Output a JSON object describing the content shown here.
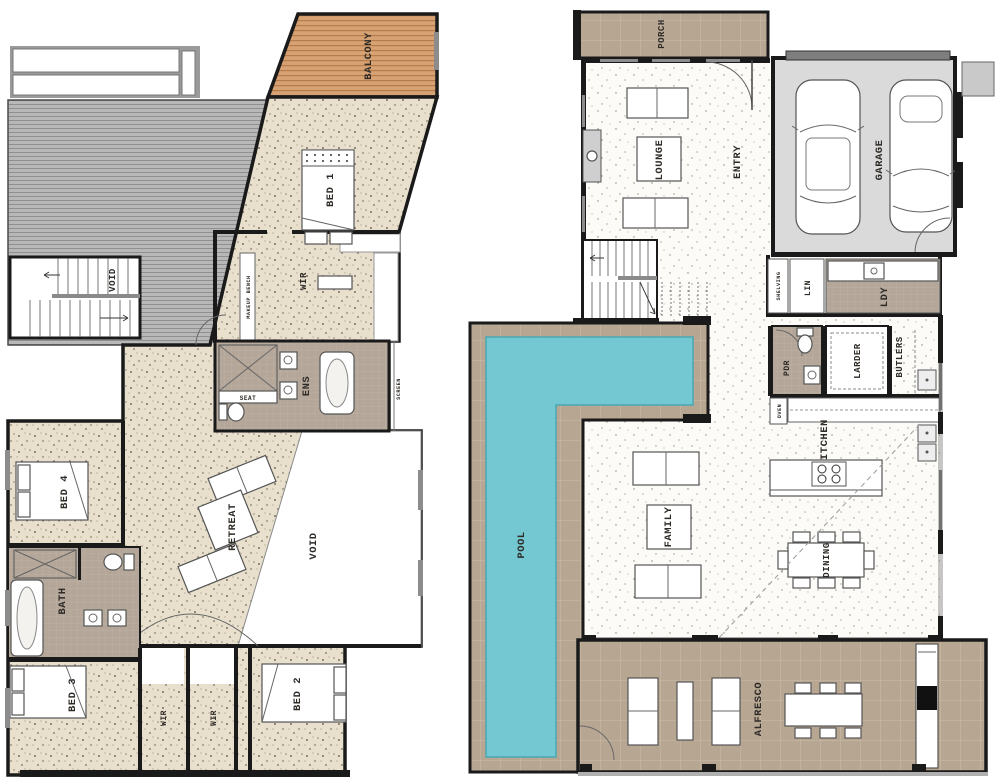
{
  "upper": {
    "balcony": "BALCONY",
    "bed1": "BED 1",
    "void_stairs": "VOID",
    "wir": "WIR",
    "makeup_bench": "MAKEUP BENCH",
    "ens": "ENS",
    "seat": "SEAT",
    "screen": "SCREEN",
    "bed4": "BED 4",
    "retreat": "RETREAT",
    "void": "VOID",
    "bath": "BATH",
    "bed3": "BED 3",
    "wir2": "WIR",
    "wir3": "WIR",
    "bed2": "BED 2"
  },
  "ground": {
    "porch": "PORCH",
    "lounge": "LOUNGE",
    "entry": "ENTRY",
    "garage": "GARAGE",
    "shelving": "SHELVING",
    "lin": "LIN",
    "ldy": "LDY",
    "pool": "POOL",
    "pdr": "PDR",
    "larder": "LARDER",
    "butlers": "BUTLERS",
    "oven": "OVEN",
    "kitchen": "KITCHEN",
    "family": "FAMILY",
    "dining": "DINING",
    "alfresco": "ALFRESCO"
  },
  "colors": {
    "carpet": "#e8e0cd",
    "timber_floor": "#fcfbf8",
    "tile": "#b7a692",
    "bath_tile": "#b4a79a",
    "deck": "#d6a274",
    "pool_water": "#73c8d2",
    "garage_floor": "#dadada",
    "roof": "#b8b8b8",
    "wall": "#1a1a1a"
  }
}
